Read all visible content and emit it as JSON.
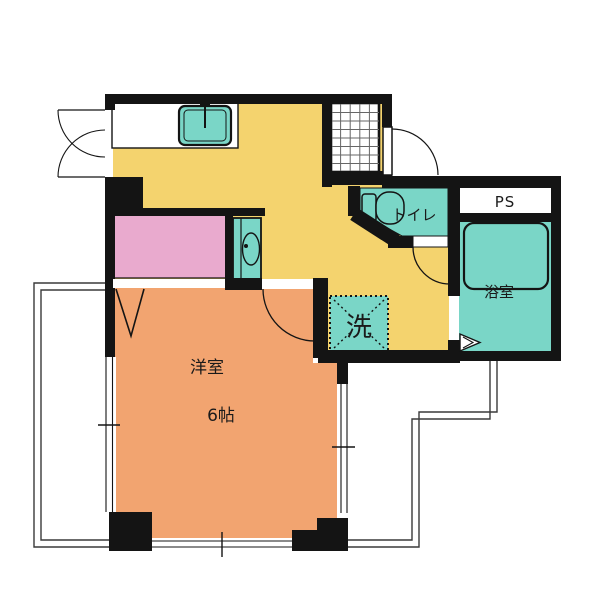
{
  "plan": {
    "name": "apartment-floor-plan",
    "labels": {
      "main_room": "洋室",
      "main_room_size": "6帖",
      "laundry": "洗",
      "toilet": "トイレ",
      "pipe_space": "PS",
      "bathroom": "浴室"
    },
    "colors": {
      "flooring": "#F4D36E",
      "room": "#F2A470",
      "closet": "#E9AACE",
      "fixture": "#7AD6C7",
      "wall": "#141414",
      "outline": "#3A3A3A",
      "grid": "#666666",
      "white": "#FFFFFF"
    }
  }
}
